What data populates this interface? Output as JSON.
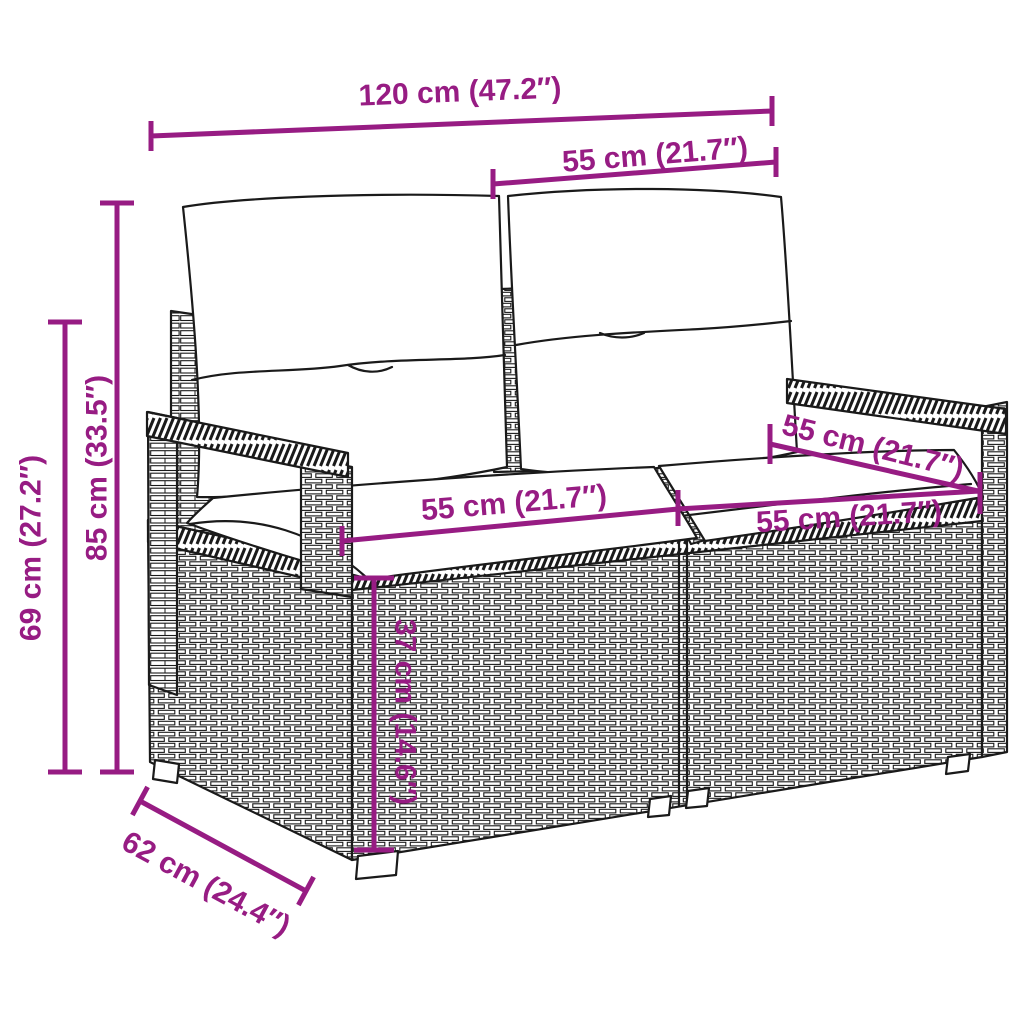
{
  "diagram": {
    "subject": "Poly rattan 2-seater garden sofa with back and seat cushions — dimension drawing",
    "accent_color": "#971C83",
    "line_color": "#1A1A1A",
    "background": "#FFFFFF"
  },
  "dims": {
    "overall_width": {
      "label": "120 cm (47.2″)"
    },
    "back_width": {
      "label": "55 cm (21.7″)"
    },
    "overall_height": {
      "label": "85 cm (33.5″)"
    },
    "arm_height": {
      "label": "69 cm (27.2″)"
    },
    "seat_width_left": {
      "label": "55 cm (21.7″)"
    },
    "seat_width_right": {
      "label": "55 cm (21.7″)"
    },
    "seat_depth": {
      "label": "55 cm (21.7″)"
    },
    "seat_height": {
      "label": "37 cm (14.6″)"
    },
    "overall_depth": {
      "label": "62 cm (24.4″)"
    }
  }
}
